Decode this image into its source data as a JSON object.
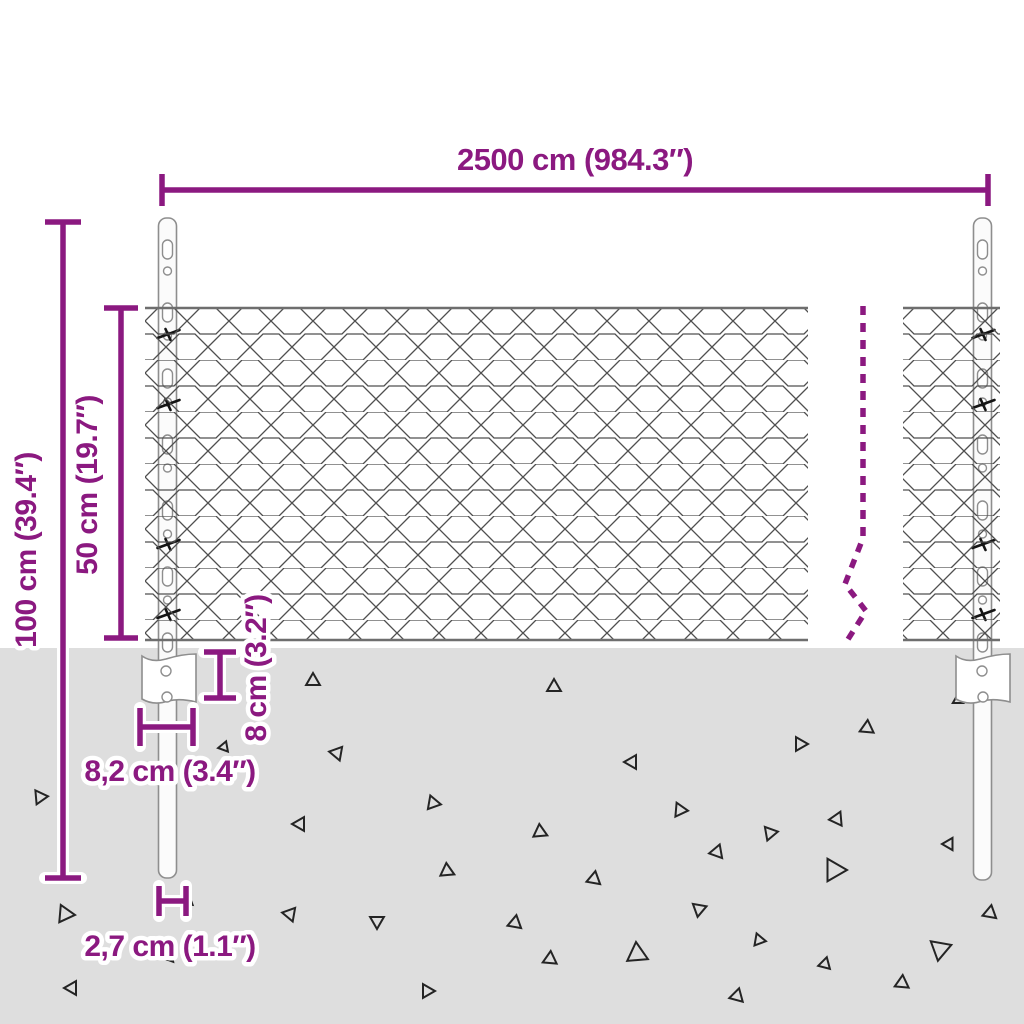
{
  "diagram": {
    "subject": "chain-link-fence-with-posts-dimension-diagram"
  },
  "dimensions": {
    "total_width": "2500 cm (984.3″)",
    "total_height": "100 cm (39.4″)",
    "mesh_height": "50 cm (19.7″)",
    "anchor_depth": "8 cm (3.2″)",
    "anchor_width": "8,2 cm (3.4″)",
    "post_width": "2,7 cm (1.1″)"
  },
  "colors": {
    "accent": "#8b1980",
    "ground": "#dedede",
    "mesh_wire": "#4f4f4f",
    "steel_outline": "#8e8e8e",
    "triangle": "#242424"
  },
  "ground": {
    "triangles": [
      [
        313,
        681,
        8,
        0
      ],
      [
        337,
        753,
        8,
        40
      ],
      [
        40,
        797,
        8,
        205
      ],
      [
        224,
        747,
        6,
        140
      ],
      [
        300,
        824,
        8,
        150
      ],
      [
        433,
        803,
        8,
        100
      ],
      [
        447,
        871,
        8,
        355
      ],
      [
        65,
        914,
        10,
        215
      ],
      [
        188,
        901,
        6,
        130
      ],
      [
        290,
        914,
        8,
        160
      ],
      [
        377,
        921,
        8,
        60
      ],
      [
        170,
        958,
        5,
        140
      ],
      [
        72,
        988,
        8,
        150
      ],
      [
        427,
        991,
        8,
        210
      ],
      [
        554,
        687,
        8,
        0
      ],
      [
        632,
        762,
        8,
        150
      ],
      [
        800,
        744,
        8,
        90
      ],
      [
        867,
        728,
        8,
        5
      ],
      [
        680,
        810,
        8,
        95
      ],
      [
        540,
        832,
        8,
        115
      ],
      [
        770,
        833,
        8,
        80
      ],
      [
        837,
        819,
        8,
        25
      ],
      [
        717,
        852,
        8,
        140
      ],
      [
        949,
        844,
        7,
        150
      ],
      [
        594,
        879,
        8,
        130
      ],
      [
        834,
        870,
        13,
        210
      ],
      [
        699,
        909,
        8,
        70
      ],
      [
        515,
        923,
        8,
        10
      ],
      [
        759,
        940,
        7,
        100
      ],
      [
        550,
        959,
        8,
        245
      ],
      [
        637,
        954,
        12,
        235
      ],
      [
        825,
        964,
        7,
        255
      ],
      [
        940,
        949,
        12,
        190
      ],
      [
        902,
        983,
        8,
        245
      ],
      [
        990,
        913,
        8,
        10
      ],
      [
        737,
        996,
        8,
        255
      ],
      [
        958,
        700,
        6,
        0
      ]
    ]
  }
}
